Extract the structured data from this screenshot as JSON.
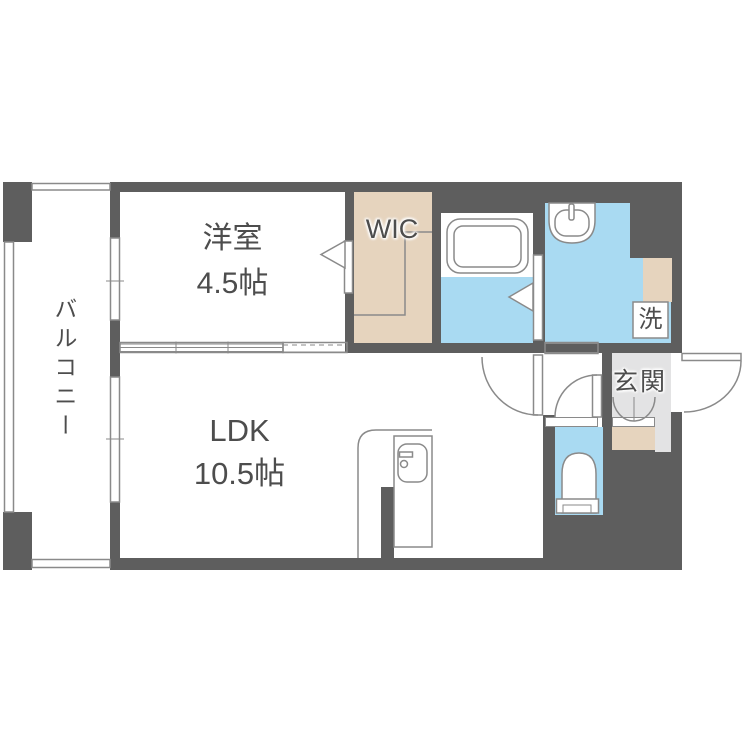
{
  "colors": {
    "wall": "#5e5e5e",
    "closet_beige": "#e6d4be",
    "water_blue": "#a9daf2",
    "entrance_gray": "#e3e3e4",
    "line": "#8a8a8a",
    "text": "#4d4d4d"
  },
  "rooms": {
    "balcony": {
      "label": "バルコニー"
    },
    "western_room": {
      "label": "洋室",
      "size": "4.5帖"
    },
    "wic": {
      "label": "WIC"
    },
    "ldk": {
      "label": "LDK",
      "size": "10.5帖"
    },
    "entrance": {
      "label": "玄関"
    },
    "laundry": {
      "label": "洗"
    }
  }
}
